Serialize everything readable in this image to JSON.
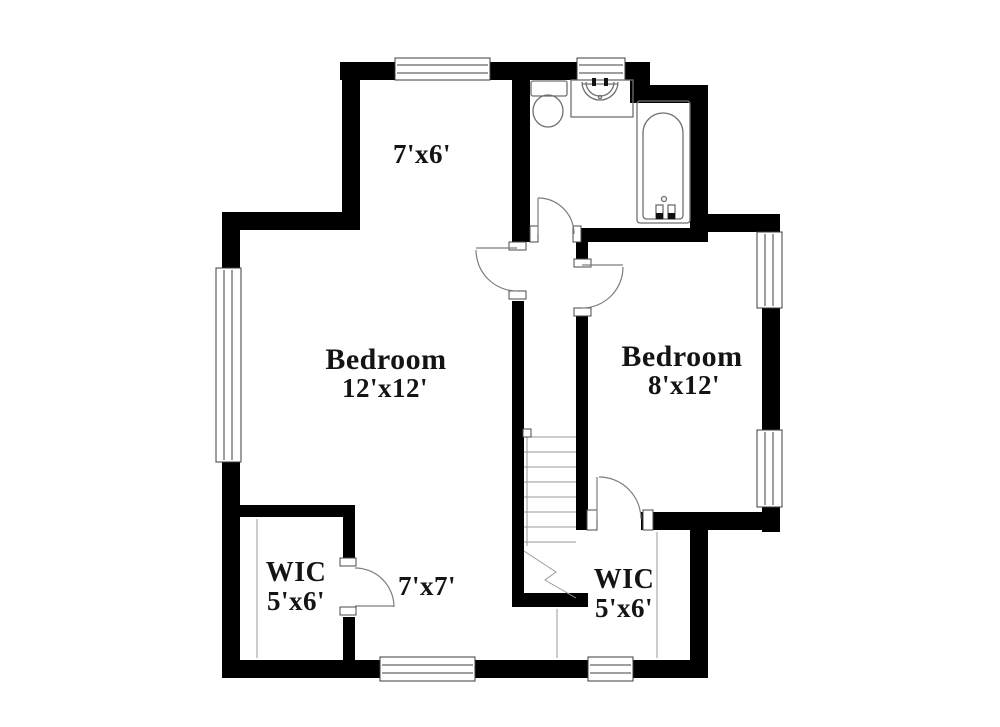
{
  "colors": {
    "background": "#ffffff",
    "walls": "#000000",
    "fixture_lines": "#6f6f6f",
    "text": "#141414"
  },
  "rooms": [
    {
      "id": "nook",
      "label": "7'x6'"
    },
    {
      "id": "bedroom-left",
      "label": "Bedroom",
      "dims": "12'x12'"
    },
    {
      "id": "bedroom-right",
      "label": "Bedroom",
      "dims": "8'x12'"
    },
    {
      "id": "wic-left",
      "label": "WIC",
      "dims": "5'x6'"
    },
    {
      "id": "area-7x7",
      "label": "7'x7'"
    },
    {
      "id": "wic-right",
      "label": "WIC",
      "dims": "5'x6'"
    }
  ]
}
